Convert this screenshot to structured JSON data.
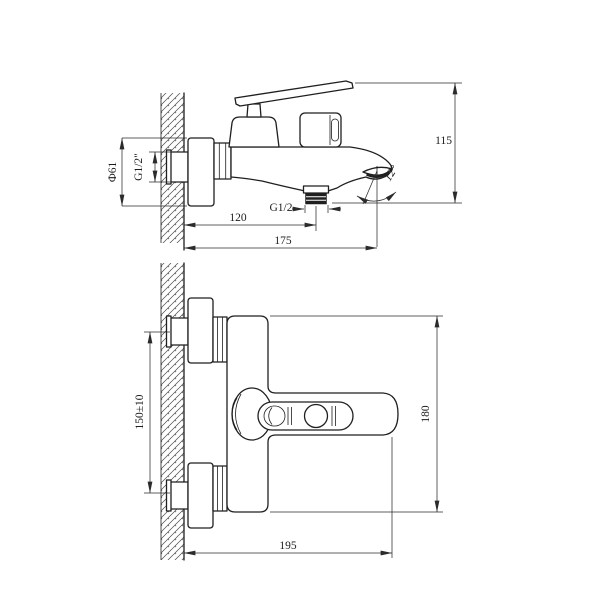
{
  "canvas": {
    "background": "#ffffff",
    "object_line_color": "#1f1f1f",
    "dimension_line_color": "#2b2b2b",
    "hatch_color": "#4a4a4a"
  },
  "views": {
    "side_view": {
      "dims": {
        "escutcheon_diameter": "Ф61",
        "inlet_thread": "G1/2\"",
        "outlet_thread": "G1/2",
        "wall_to_outlet": "120",
        "wall_to_spout_tip": "175",
        "overall_height": "115",
        "spout_angle": "12°"
      }
    },
    "plan_view": {
      "dims": {
        "inlet_spacing": "150±10",
        "body_width": "180",
        "wall_projection": "195"
      }
    }
  }
}
